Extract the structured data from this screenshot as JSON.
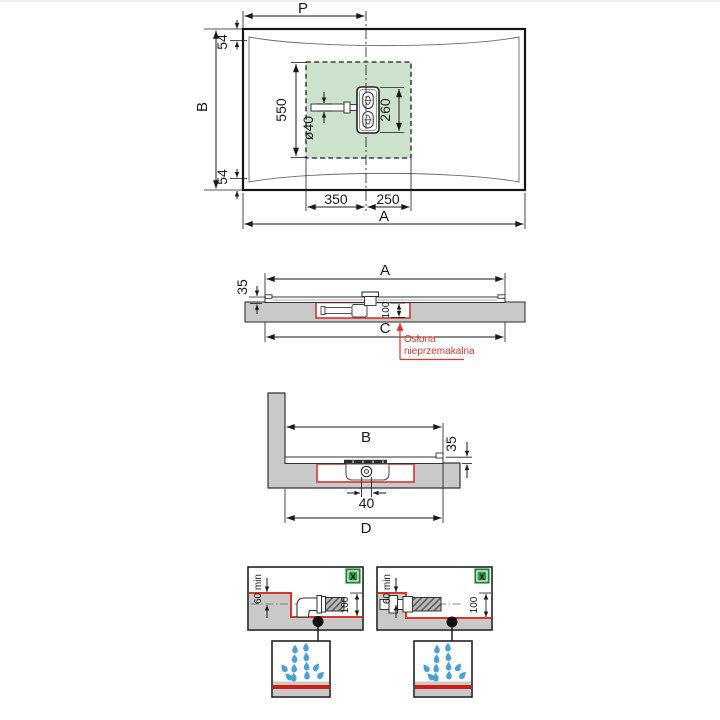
{
  "plan_view": {
    "p": "P",
    "b": "B",
    "a": "A",
    "edge_top": "54",
    "edge_bottom": "54",
    "drain_zone": "550",
    "pipe_diameter": "ø40",
    "drain_cover": "260",
    "offset_left": "350",
    "offset_right": "250"
  },
  "long_section": {
    "a": "A",
    "tray_height": "35",
    "recess_depth": "100",
    "c": "C",
    "note": "Osłona nieprzemakalna"
  },
  "cross_section": {
    "b": "B",
    "tray_height": "35",
    "pipe": "40",
    "d": "D"
  },
  "details": {
    "left": {
      "badge": "X",
      "min_depth": "60 min",
      "recess_depth": "100"
    },
    "right": {
      "badge": "X",
      "min_depth": "60 min",
      "recess_depth": "100"
    }
  },
  "colors": {
    "zone_green": "#cce2cc",
    "slab_gray": "#c9c9c9",
    "waterproof_red": "#e23327",
    "drop_blue": "#4aa0d8",
    "badge_green": "#2f9e45",
    "ink": "#1a1a1a"
  }
}
